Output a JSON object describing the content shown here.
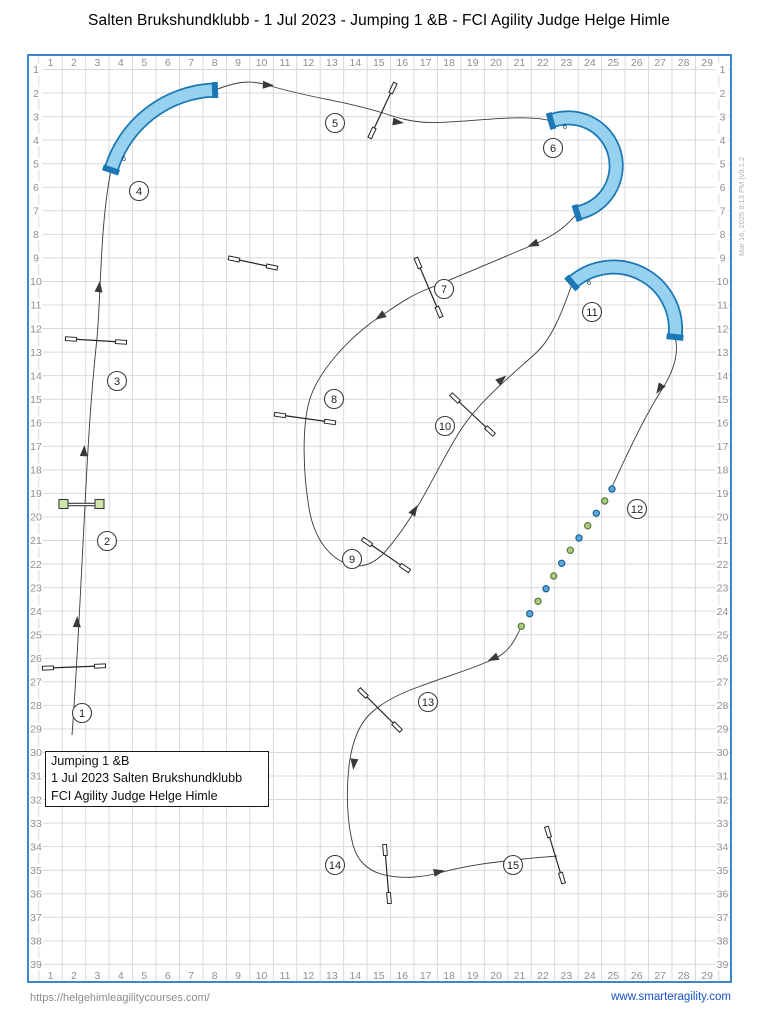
{
  "title": "Salten Brukshundklubb - 1 Jul 2023 - Jumping 1 &B - FCI Agility Judge Helge Himle",
  "meta_note": "Mar 16, 2025 9:13 PM  (v9.1.2",
  "info_box": {
    "lines": [
      "Jumping 1 &B",
      "1 Jul 2023 Salten Brukshundklubb",
      "FCI Agility Judge Helge Himle"
    ]
  },
  "footer": {
    "left_url": "https://helgehimleagilitycourses.com/",
    "right_url": "www.smarteragility.com"
  },
  "colors": {
    "border": "#3e86c9",
    "grid_line": "#d9d9d9",
    "label": "#8f8f8f",
    "path": "#3a3a3a",
    "tunnel_dark": "#1b77b5",
    "tunnel_fill": "#96d2f0",
    "tunnel_label": "#123c5c",
    "jump": "#262626",
    "wing_fill": "#ffffff",
    "green_fill": "#cfe6a9",
    "green_stroke": "#3d3d3d",
    "weave_blue": "#58a8da",
    "weave_blue_stroke": "#1d6193",
    "weave_green": "#a9cc80",
    "weave_green_stroke": "#5c7a3e",
    "number_fill": "#ffffff",
    "number_stroke": "#3d3d3d",
    "number_text": "#1f1f1f"
  },
  "grid": {
    "cols": 29,
    "rows": 39,
    "box": {
      "x": 28,
      "y": 55,
      "w": 703,
      "h": 927
    },
    "col_start_x": 50.5,
    "col_step": 23.45,
    "row_start_y": 69.5,
    "row_step": 23.55,
    "vline_start": 38.8,
    "top_label_y": 66,
    "bottom_label_y": 979,
    "left_label_x": 36,
    "right_label_x": 722.5,
    "label_font": 10.5
  },
  "course": {
    "segments": [
      "M72,735 C77,670 81,580 85,505 C89,425 92,385 97,338 C101,295 100,225 111,170",
      "M111,170 A112,112 0 0 1 215,90",
      "M215,90 C238,81 252,80 267,85 C310,98 345,101 383,113 C401,119 410,121 421,122 C455,125 523,112 551,121",
      "M551,121 A48,48 0 1 1 577,213",
      "M577,213 C567,227 551,237 535,244 C497,260 462,275 430,288 C409,296 396,306 381,316 C350,336 317,372 309,402 C302,428 303,473 309,508 C314,539 330,559 350,565 C362,568 372,564 381,556 C392,545 404,528 416,509 C432,483 446,452 462,428 C482,398 520,368 537,352 C552,338 563,310 572,284",
      "M572,283 A62,62 0 0 1 675,337",
      "M675,337 C680,355 672,374 661,391 C645,416 628,452 612,487",
      "M521,627 C515,641 508,652 496,658 C473,669 447,676 421,686 C401,693 384,701 371,713 C359,724 352,741 349,766 C346,792 347,822 353,845 C357,860 367,870 381,874 C403,880 424,877 443,872 C472,864 506,861 524,859 C538,857 549,857 557,856"
    ],
    "arrows": [
      {
        "x": 77,
        "y": 623,
        "a": -88
      },
      {
        "x": 84,
        "y": 452,
        "a": -87
      },
      {
        "x": 99,
        "y": 288,
        "a": -83
      },
      {
        "x": 267,
        "y": 85,
        "a": 3
      },
      {
        "x": 397,
        "y": 122,
        "a": 8
      },
      {
        "x": 534,
        "y": 244,
        "a": 157
      },
      {
        "x": 381,
        "y": 316,
        "a": 146
      },
      {
        "x": 414,
        "y": 511,
        "a": -58
      },
      {
        "x": 501,
        "y": 380,
        "a": -40
      },
      {
        "x": 660,
        "y": 388,
        "a": 122
      },
      {
        "x": 494,
        "y": 658,
        "a": 155
      },
      {
        "x": 354,
        "y": 763,
        "a": 96
      },
      {
        "x": 438,
        "y": 872,
        "a": -12
      }
    ],
    "tunnels": [
      {
        "d": "M111,170 A112,112 0 0 1 215,90",
        "caps": [
          [
            103,
            167.3,
            119,
            172.7
          ],
          [
            214.7,
            82,
            215.3,
            98
          ]
        ],
        "label": "6",
        "lx": 124,
        "ly": 161
      },
      {
        "d": "M551,121 A48,48 0 1 1 577,213",
        "caps": [
          [
            548.7,
            112.8,
            553.3,
            129.2
          ],
          [
            574.4,
            204.9,
            579.6,
            221.1
          ]
        ],
        "label": "6",
        "lx": 565,
        "ly": 129
      },
      {
        "d": "M572,283 A62,62 0 0 1 675,337",
        "caps": [
          [
            566.4,
            276.6,
            577.6,
            289.4
          ],
          [
            666.6,
            336.1,
            683.4,
            337.9
          ]
        ],
        "label": "6",
        "lx": 589,
        "ly": 285
      }
    ],
    "jumps": [
      {
        "x1": 48,
        "y1": 668,
        "x2": 100,
        "y2": 666
      },
      {
        "x1": 71,
        "y1": 339,
        "x2": 121,
        "y2": 342
      },
      {
        "x1": 393,
        "y1": 88,
        "x2": 372,
        "y2": 133
      },
      {
        "x1": 418,
        "y1": 263,
        "x2": 439,
        "y2": 312
      },
      {
        "x1": 280,
        "y1": 415,
        "x2": 330,
        "y2": 422
      },
      {
        "x1": 367,
        "y1": 542,
        "x2": 405,
        "y2": 568
      },
      {
        "x1": 455,
        "y1": 398,
        "x2": 490,
        "y2": 431
      },
      {
        "x1": 363,
        "y1": 693,
        "x2": 397,
        "y2": 727
      },
      {
        "x1": 385,
        "y1": 850,
        "x2": 389,
        "y2": 898
      },
      {
        "x1": 548,
        "y1": 832,
        "x2": 562,
        "y2": 878
      },
      {
        "x1": 234,
        "y1": 259,
        "x2": 272,
        "y2": 267
      }
    ],
    "green_jump": {
      "x1": 59,
      "y1": 504.5,
      "x2": 104,
      "y2": 504.5,
      "squares": [
        [
          63.5,
          504
        ],
        [
          99.5,
          504
        ]
      ],
      "size": 9
    },
    "weave_poles": [
      {
        "x": 612,
        "y": 489,
        "c": "b"
      },
      {
        "x": 604.7,
        "y": 501,
        "c": "g"
      },
      {
        "x": 596.3,
        "y": 513.3,
        "c": "b"
      },
      {
        "x": 587.7,
        "y": 525.7,
        "c": "g"
      },
      {
        "x": 579,
        "y": 538,
        "c": "b"
      },
      {
        "x": 570.3,
        "y": 550.3,
        "c": "g"
      },
      {
        "x": 561.7,
        "y": 563.3,
        "c": "b"
      },
      {
        "x": 553.7,
        "y": 576,
        "c": "g"
      },
      {
        "x": 546,
        "y": 588.7,
        "c": "b"
      },
      {
        "x": 538,
        "y": 601.3,
        "c": "g"
      },
      {
        "x": 529.7,
        "y": 613.7,
        "c": "b"
      },
      {
        "x": 521.3,
        "y": 626.3,
        "c": "g"
      }
    ],
    "numbers": [
      {
        "n": "1",
        "x": 82,
        "y": 713
      },
      {
        "n": "2",
        "x": 107,
        "y": 541
      },
      {
        "n": "3",
        "x": 117,
        "y": 381
      },
      {
        "n": "4",
        "x": 139,
        "y": 191
      },
      {
        "n": "5",
        "x": 335,
        "y": 123
      },
      {
        "n": "6",
        "x": 553,
        "y": 148
      },
      {
        "n": "7",
        "x": 444,
        "y": 289
      },
      {
        "n": "8",
        "x": 334,
        "y": 399
      },
      {
        "n": "9",
        "x": 352,
        "y": 559
      },
      {
        "n": "10",
        "x": 445,
        "y": 426
      },
      {
        "n": "11",
        "x": 592,
        "y": 312
      },
      {
        "n": "12",
        "x": 637,
        "y": 509
      },
      {
        "n": "13",
        "x": 428,
        "y": 702
      },
      {
        "n": "14",
        "x": 335,
        "y": 865
      },
      {
        "n": "15",
        "x": 513,
        "y": 865
      }
    ]
  }
}
